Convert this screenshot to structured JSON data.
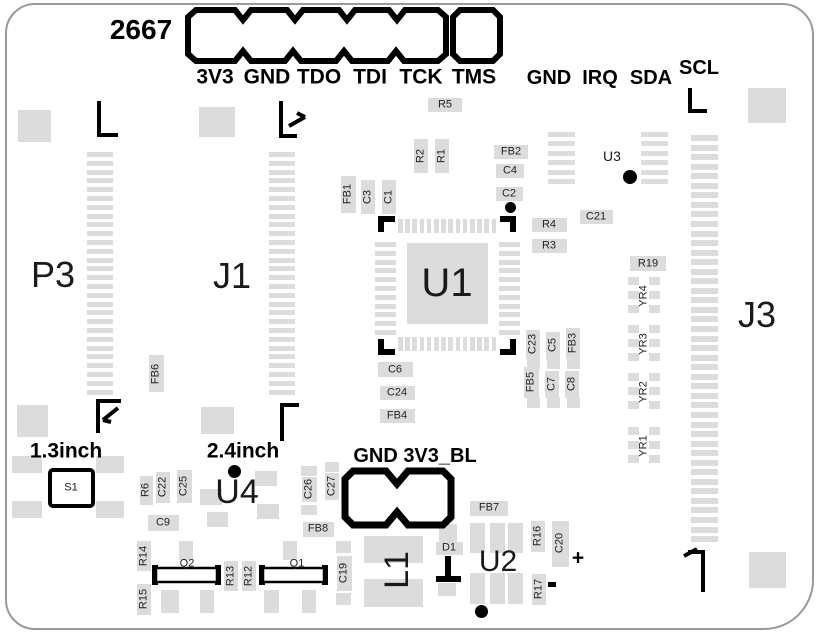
{
  "colors": {
    "pad": "#dcdcdc",
    "silk": "#000000",
    "edge": "#9a9a9a",
    "background": "#ffffff"
  },
  "board_marking": {
    "text": "2667"
  },
  "top_connector": {
    "pins": [
      {
        "label": "3V3",
        "x": 215
      },
      {
        "label": "GND",
        "x": 267
      },
      {
        "label": "TDO",
        "x": 319
      },
      {
        "label": "TDI",
        "x": 370
      },
      {
        "label": "TCK",
        "x": 421
      },
      {
        "label": "TMS",
        "x": 474
      }
    ],
    "label_y": 77
  },
  "i2c_header": {
    "labels": [
      {
        "text": "GND",
        "x": 549,
        "y": 78
      },
      {
        "text": "IRQ",
        "x": 600,
        "y": 78
      },
      {
        "text": "SDA",
        "x": 651,
        "y": 78
      },
      {
        "text": "SCL",
        "x": 699,
        "y": 68
      }
    ]
  },
  "backlight_header": {
    "text": "GND 3V3_BL",
    "x": 415,
    "y": 456
  },
  "annotations": [
    {
      "text": "1.3inch",
      "x": 66,
      "y": 451
    },
    {
      "text": "2.4inch",
      "x": 243,
      "y": 451
    }
  ],
  "polarity_marks": {
    "plus": {
      "text": "+",
      "x": 578,
      "y": 558
    }
  },
  "large_refs": [
    {
      "ref": "P3",
      "x": 53,
      "y": 275,
      "size": 36
    },
    {
      "ref": "J1",
      "x": 232,
      "y": 276,
      "size": 36
    },
    {
      "ref": "J3",
      "x": 757,
      "y": 315,
      "size": 36
    },
    {
      "ref": "U1",
      "x": 447,
      "y": 283,
      "size": 40
    },
    {
      "ref": "U3",
      "x": 612,
      "y": 156,
      "size": 14
    },
    {
      "ref": "U4",
      "x": 237,
      "y": 492,
      "size": 34
    },
    {
      "ref": "U2",
      "x": 498,
      "y": 562,
      "size": 30
    },
    {
      "ref": "L1",
      "x": 397,
      "y": 570,
      "size": 34,
      "rot": 90
    },
    {
      "ref": "S1",
      "x": 71,
      "y": 488,
      "size": 11
    }
  ],
  "small_refs": [
    {
      "ref": "R5",
      "x": 445,
      "y": 105,
      "rot": 0,
      "pad": [
        428,
        98,
        34,
        14
      ]
    },
    {
      "ref": "R2",
      "x": 421,
      "y": 156,
      "rot": 90,
      "pad": [
        414,
        139,
        14,
        34
      ]
    },
    {
      "ref": "R1",
      "x": 442,
      "y": 156,
      "rot": 90,
      "pad": [
        435,
        139,
        14,
        34
      ]
    },
    {
      "ref": "FB1",
      "x": 348,
      "y": 194,
      "rot": 90,
      "pad": [
        341,
        176,
        15,
        37
      ]
    },
    {
      "ref": "C3",
      "x": 368,
      "y": 197,
      "rot": 90,
      "pad": [
        361,
        180,
        14,
        34
      ]
    },
    {
      "ref": "C1",
      "x": 389,
      "y": 197,
      "rot": 90,
      "pad": [
        382,
        180,
        14,
        34
      ]
    },
    {
      "ref": "FB2",
      "x": 511,
      "y": 152,
      "rot": 0,
      "pad": [
        494,
        145,
        34,
        14
      ]
    },
    {
      "ref": "C4",
      "x": 510,
      "y": 171,
      "rot": 0,
      "pad": [
        496,
        164,
        28,
        14
      ]
    },
    {
      "ref": "C2",
      "x": 509,
      "y": 194,
      "rot": 0,
      "pad": [
        496,
        187,
        27,
        14
      ]
    },
    {
      "ref": "C21",
      "x": 596,
      "y": 217,
      "rot": 0,
      "pad": [
        580,
        210,
        33,
        14
      ]
    },
    {
      "ref": "R4",
      "x": 549,
      "y": 225,
      "rot": 0,
      "pad": [
        532,
        218,
        35,
        14
      ]
    },
    {
      "ref": "R3",
      "x": 549,
      "y": 246,
      "rot": 0,
      "pad": [
        532,
        239,
        35,
        14
      ]
    },
    {
      "ref": "C6",
      "x": 395,
      "y": 370,
      "rot": 0,
      "pad": [
        378,
        362,
        35,
        15
      ]
    },
    {
      "ref": "C24",
      "x": 397,
      "y": 393,
      "rot": 0,
      "pad": [
        380,
        386,
        35,
        14
      ]
    },
    {
      "ref": "FB4",
      "x": 397,
      "y": 416,
      "rot": 0,
      "pad": [
        380,
        409,
        35,
        14
      ]
    },
    {
      "ref": "C23",
      "x": 533,
      "y": 344,
      "rot": 90,
      "pad": [
        526,
        330,
        14,
        29
      ]
    },
    {
      "ref": "C5",
      "x": 553,
      "y": 345,
      "rot": 90,
      "pad": [
        546,
        332,
        14,
        27
      ]
    },
    {
      "ref": "FB3",
      "x": 573,
      "y": 343,
      "rot": 90,
      "pad": [
        566,
        328,
        14,
        31
      ]
    },
    {
      "ref": "FB5",
      "x": 531,
      "y": 382,
      "rot": 90,
      "pad": [
        524,
        367,
        15,
        31
      ]
    },
    {
      "ref": "C7",
      "x": 552,
      "y": 384,
      "rot": 90,
      "pad": [
        545,
        371,
        14,
        27
      ]
    },
    {
      "ref": "C8",
      "x": 572,
      "y": 384,
      "rot": 90,
      "pad": [
        565,
        371,
        14,
        27
      ]
    },
    {
      "ref": "FB6",
      "x": 156,
      "y": 374,
      "rot": 90,
      "pad": [
        149,
        355,
        15,
        37
      ]
    },
    {
      "ref": "R19",
      "x": 648,
      "y": 264,
      "rot": 0,
      "pad": [
        630,
        256,
        36,
        15
      ]
    },
    {
      "ref": "YR4",
      "x": 644,
      "y": 296,
      "rot": 90,
      "pad": null
    },
    {
      "ref": "YR3",
      "x": 644,
      "y": 344,
      "rot": 90,
      "pad": null
    },
    {
      "ref": "YR2",
      "x": 644,
      "y": 392,
      "rot": 90,
      "pad": null
    },
    {
      "ref": "YR1",
      "x": 644,
      "y": 446,
      "rot": 90,
      "pad": null
    },
    {
      "ref": "R6",
      "x": 146,
      "y": 490,
      "rot": 90,
      "pad": [
        140,
        476,
        13,
        29
      ]
    },
    {
      "ref": "C22",
      "x": 163,
      "y": 487,
      "rot": 90,
      "pad": [
        156,
        472,
        14,
        31
      ]
    },
    {
      "ref": "C25",
      "x": 184,
      "y": 486,
      "rot": 90,
      "pad": [
        177,
        470,
        15,
        33
      ]
    },
    {
      "ref": "C9",
      "x": 163,
      "y": 523,
      "rot": 0,
      "pad": [
        148,
        515,
        31,
        16
      ]
    },
    {
      "ref": "C26",
      "x": 309,
      "y": 489,
      "rot": 90,
      "pad": [
        302,
        477,
        15,
        25
      ]
    },
    {
      "ref": "C27",
      "x": 332,
      "y": 486,
      "rot": 90,
      "pad": [
        325,
        473,
        14,
        27
      ]
    },
    {
      "ref": "FB8",
      "x": 318,
      "y": 529,
      "rot": 0,
      "pad": [
        303,
        522,
        31,
        15
      ]
    },
    {
      "ref": "FB7",
      "x": 489,
      "y": 508,
      "rot": 0,
      "pad": [
        470,
        501,
        38,
        15
      ]
    },
    {
      "ref": "C19",
      "x": 344,
      "y": 573,
      "rot": 90,
      "pad": [
        337,
        556,
        15,
        35
      ]
    },
    {
      "ref": "D1",
      "x": 449,
      "y": 548,
      "rot": 0,
      "pad": [
        436,
        542,
        27,
        13
      ]
    },
    {
      "ref": "R14",
      "x": 144,
      "y": 556,
      "rot": 90,
      "pad": [
        137,
        541,
        14,
        30
      ]
    },
    {
      "ref": "R15",
      "x": 144,
      "y": 599,
      "rot": 90,
      "pad": [
        137,
        584,
        14,
        31
      ]
    },
    {
      "ref": "R13",
      "x": 231,
      "y": 576,
      "rot": 90,
      "pad": [
        224,
        561,
        14,
        30
      ]
    },
    {
      "ref": "R12",
      "x": 249,
      "y": 576,
      "rot": 90,
      "pad": [
        242,
        561,
        14,
        30
      ]
    },
    {
      "ref": "R16",
      "x": 538,
      "y": 536,
      "rot": 90,
      "pad": [
        531,
        521,
        14,
        31
      ]
    },
    {
      "ref": "C20",
      "x": 560,
      "y": 543,
      "rot": 90,
      "pad": [
        552,
        521,
        17,
        46
      ]
    },
    {
      "ref": "R17",
      "x": 539,
      "y": 589,
      "rot": 90,
      "pad": [
        532,
        574,
        14,
        31
      ]
    },
    {
      "ref": "Q2",
      "x": 187,
      "y": 564,
      "rot": 0,
      "pad": null
    },
    {
      "ref": "Q1",
      "x": 297,
      "y": 564,
      "rot": 0,
      "pad": null
    }
  ],
  "pads": {
    "rects": [
      [
        18,
        110,
        33,
        32
      ],
      [
        199,
        107,
        36,
        30
      ],
      [
        748,
        88,
        38,
        35
      ],
      [
        17,
        405,
        31,
        32
      ],
      [
        201,
        407,
        33,
        27
      ],
      [
        749,
        552,
        37,
        36
      ],
      [
        12,
        456,
        30,
        17
      ],
      [
        12,
        501,
        30,
        17
      ],
      [
        96,
        456,
        28,
        17
      ],
      [
        96,
        501,
        28,
        17
      ],
      [
        200,
        489,
        22,
        16
      ],
      [
        207,
        512,
        21,
        15
      ],
      [
        255,
        471,
        22,
        15
      ],
      [
        257,
        504,
        22,
        15
      ],
      [
        407,
        243,
        81,
        81
      ],
      [
        527,
        359,
        13,
        10
      ],
      [
        547,
        359,
        13,
        10
      ],
      [
        567,
        359,
        13,
        10
      ],
      [
        527,
        397,
        13,
        11
      ],
      [
        547,
        397,
        13,
        11
      ],
      [
        567,
        397,
        13,
        11
      ],
      [
        301,
        466,
        16,
        10
      ],
      [
        301,
        505,
        16,
        10
      ],
      [
        325,
        462,
        14,
        10
      ],
      [
        439,
        524,
        18,
        18
      ],
      [
        438,
        583,
        18,
        13
      ],
      [
        364,
        536,
        59,
        27
      ],
      [
        364,
        579,
        59,
        28
      ],
      [
        470,
        523,
        15,
        30
      ],
      [
        490,
        523,
        15,
        30
      ],
      [
        508,
        523,
        15,
        30
      ],
      [
        470,
        573,
        15,
        31
      ],
      [
        490,
        573,
        15,
        31
      ],
      [
        508,
        573,
        15,
        31
      ],
      [
        179,
        541,
        14,
        19
      ],
      [
        161,
        590,
        18,
        23
      ],
      [
        200,
        590,
        14,
        23
      ],
      [
        283,
        541,
        14,
        19
      ],
      [
        264,
        590,
        15,
        23
      ],
      [
        302,
        590,
        14,
        23
      ],
      [
        336,
        541,
        15,
        12
      ],
      [
        336,
        593,
        15,
        12
      ],
      [
        628,
        277,
        11,
        8
      ],
      [
        649,
        277,
        11,
        8
      ],
      [
        628,
        291,
        11,
        8
      ],
      [
        649,
        291,
        11,
        8
      ],
      [
        628,
        305,
        11,
        8
      ],
      [
        649,
        305,
        11,
        8
      ],
      [
        628,
        325,
        11,
        8
      ],
      [
        649,
        325,
        11,
        8
      ],
      [
        628,
        339,
        11,
        8
      ],
      [
        649,
        339,
        11,
        8
      ],
      [
        628,
        353,
        11,
        8
      ],
      [
        649,
        353,
        11,
        8
      ],
      [
        628,
        373,
        11,
        8
      ],
      [
        649,
        373,
        11,
        8
      ],
      [
        628,
        387,
        11,
        8
      ],
      [
        649,
        387,
        11,
        8
      ],
      [
        628,
        401,
        11,
        8
      ],
      [
        649,
        401,
        11,
        8
      ],
      [
        628,
        427,
        11,
        8
      ],
      [
        649,
        427,
        11,
        8
      ],
      [
        628,
        441,
        11,
        8
      ],
      [
        649,
        441,
        11,
        8
      ],
      [
        628,
        455,
        11,
        8
      ],
      [
        649,
        455,
        11,
        8
      ]
    ],
    "ladders": [
      {
        "x": 87,
        "y": 152,
        "w": 26,
        "h": 5,
        "count": 28,
        "pitch": 8.8,
        "dir": "v"
      },
      {
        "x": 269,
        "y": 152,
        "w": 26,
        "h": 5,
        "count": 28,
        "pitch": 8.8,
        "dir": "v"
      },
      {
        "x": 691,
        "y": 135,
        "w": 27,
        "h": 6,
        "count": 43,
        "pitch": 9.55,
        "dir": "v"
      },
      {
        "x": 548,
        "y": 132,
        "w": 27,
        "h": 5,
        "count": 6,
        "pitch": 9.4,
        "dir": "v"
      },
      {
        "x": 641,
        "y": 132,
        "w": 27,
        "h": 5,
        "count": 6,
        "pitch": 9.4,
        "dir": "v"
      },
      {
        "x": 375,
        "y": 242,
        "w": 21,
        "h": 5,
        "count": 11,
        "pitch": 8.8,
        "dir": "v"
      },
      {
        "x": 499,
        "y": 242,
        "w": 21,
        "h": 5,
        "count": 11,
        "pitch": 8.8,
        "dir": "v"
      },
      {
        "x": 398,
        "y": 219,
        "w": 4.5,
        "h": 14,
        "count": 14,
        "pitch": 7.2,
        "dir": "h"
      },
      {
        "x": 398,
        "y": 337,
        "w": 4.5,
        "h": 14,
        "count": 14,
        "pitch": 7.2,
        "dir": "h"
      }
    ]
  },
  "silk_rects": [
    [
      445,
      556,
      6,
      22
    ],
    [
      436,
      576,
      25,
      6
    ],
    [
      152,
      565,
      6,
      20
    ],
    [
      215,
      565,
      6,
      20
    ],
    [
      259,
      565,
      6,
      20
    ],
    [
      322,
      565,
      6,
      20
    ],
    [
      548,
      582,
      8,
      5
    ]
  ],
  "dots": [
    {
      "x": 510,
      "y": 207,
      "r": 5.5
    },
    {
      "x": 630,
      "y": 177,
      "r": 7
    },
    {
      "x": 234,
      "y": 471,
      "r": 6.5
    },
    {
      "x": 481,
      "y": 611,
      "r": 6.5
    }
  ]
}
